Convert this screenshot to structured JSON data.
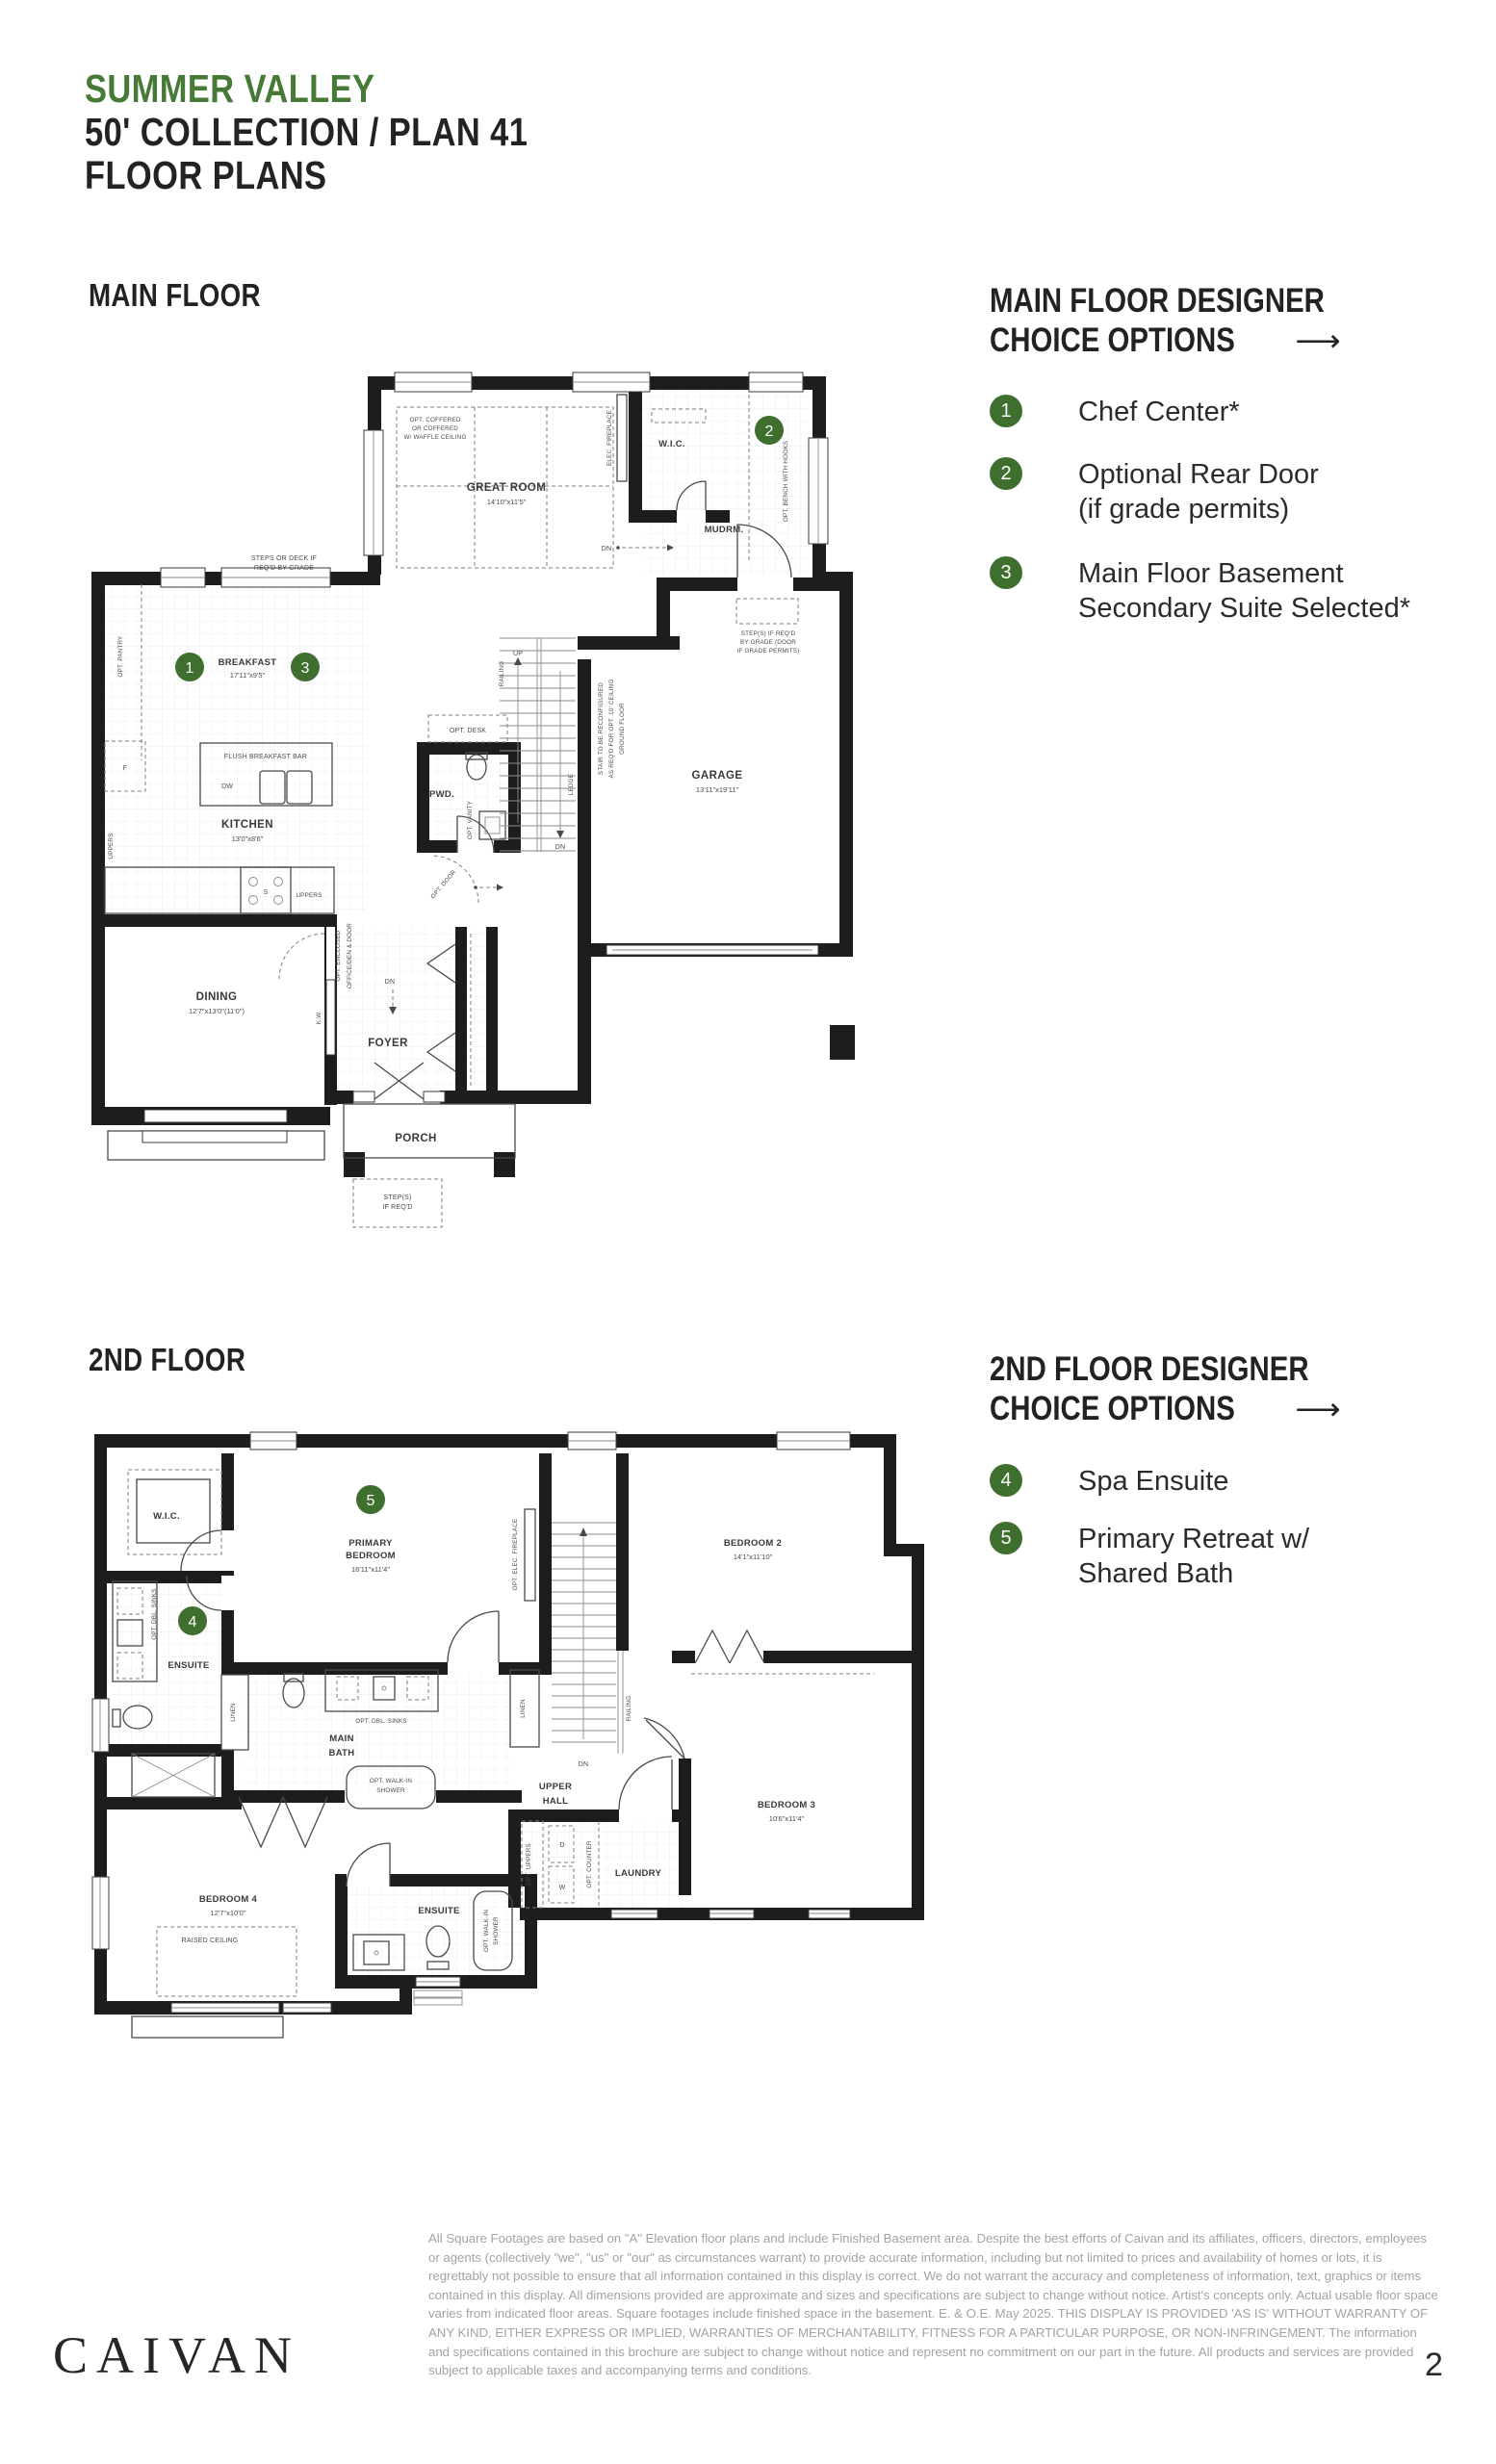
{
  "theme": {
    "green": "#3E6F2E",
    "ink": "#1d1d1d"
  },
  "header": {
    "community": "SUMMER VALLEY",
    "collection": "50' COLLECTION / PLAN 41",
    "title": "FLOOR PLANS"
  },
  "main_section": {
    "label": "MAIN FLOOR"
  },
  "second_section": {
    "label": "2ND FLOOR"
  },
  "main_options": {
    "heading1": "MAIN FLOOR DESIGNER",
    "heading2": "CHOICE OPTIONS",
    "arrow": "⟶",
    "items": [
      {
        "num": "1",
        "line1": "Chef Center*",
        "line2": ""
      },
      {
        "num": "2",
        "line1": "Optional Rear Door",
        "line2": "(if grade permits)"
      },
      {
        "num": "3",
        "line1": "Main Floor Basement",
        "line2": "Secondary Suite Selected*"
      }
    ]
  },
  "second_options": {
    "heading1": "2ND FLOOR DESIGNER",
    "heading2": "CHOICE OPTIONS",
    "arrow": "⟶",
    "items": [
      {
        "num": "4",
        "line1": "Spa Ensuite",
        "line2": ""
      },
      {
        "num": "5",
        "line1": "Primary Retreat w/",
        "line2": "Shared Bath"
      }
    ]
  },
  "main_plan": {
    "steps_deck1": "STEPS OR DECK IF",
    "steps_deck2": "REQ'D BY GRADE",
    "coffered1": "OPT. COFFERED",
    "coffered2": "OR COFFERED",
    "coffered3": "W/ WAFFLE CEILING",
    "great_room": "GREAT ROOM",
    "great_room_dims": "14'10\"x11'5\"",
    "elec_fireplace": "ELEC. FIREPLACE",
    "wic": "W.I.C.",
    "badge1": "1",
    "badge2": "2",
    "badge3": "3",
    "mudrm": "MUDRM.",
    "bench": "OPT. BENCH WITH HOOKS",
    "dn": "DN",
    "up": "UP",
    "breakfast": "BREAKFAST",
    "breakfast_dims": "17'11\"x9'5\"",
    "opt_pantry": "OPT. PANTRY",
    "flush_bar": "FLUSH BREAKFAST BAR",
    "dw": "DW",
    "fridge": "F",
    "sink": "S",
    "uppers": "UPPERS",
    "kitchen": "KITCHEN",
    "kitchen_dims": "13'0\"x8'6\"",
    "opt_desk": "OPT. DESK",
    "pwd": "PWD.",
    "opt_vanity": "OPT. VANITY",
    "railing": "RAILING",
    "ledge": "LEDGE",
    "stair_note1": "STAIR TO BE RECONFIGURED",
    "stair_note2": "AS REQ'D FOR OPT. 10' CEILING",
    "stair_note3": "GROUND FLOOR",
    "garage": "GARAGE",
    "garage_dims": "13'11\"x19'11\"",
    "gstep1": "STEP(S) IF REQ'D",
    "gstep2": "BY GRADE (DOOR",
    "gstep3": "IF GRADE PERMITS)",
    "dining": "DINING",
    "dining_dims": "12'7\"x13'0\"(11'0\")",
    "office1": "OPT. ENCLOSED",
    "office2": "OFFICE/DEN & DOOR",
    "kw": "K.W.",
    "opt_door": "OPT. DOOR",
    "foyer": "FOYER",
    "porch": "PORCH",
    "pstep1": "STEP(S)",
    "pstep2": "IF REQ'D"
  },
  "second_plan": {
    "wic": "W.I.C.",
    "badge4": "4",
    "badge5": "5",
    "primary1": "PRIMARY",
    "primary2": "BEDROOM",
    "primary_dims": "16'11\"x11'4\"",
    "fireplace": "OPT. ELEC. FIREPLACE",
    "bedroom2": "BEDROOM 2",
    "bedroom2_dims": "14'1\"x11'10\"",
    "dbl_sinks": "OPT. DBL. SINKS",
    "ensuite": "ENSUITE",
    "linen": "LINEN",
    "main1": "MAIN",
    "main2": "BATH",
    "walkin1": "OPT. WALK-IN",
    "walkin2": "SHOWER",
    "upper1": "UPPER",
    "upper2": "HALL",
    "railing": "RAILING",
    "dn": "DN",
    "laundry": "LAUNDRY",
    "opt_uppers": "OPT. UPPERS",
    "opt_counter": "OPT. COUNTER",
    "washer": "W",
    "dryer": "D",
    "bedroom3": "BEDROOM 3",
    "bedroom3_dims": "10'6\"x11'4\"",
    "bedroom4": "BEDROOM 4",
    "bedroom4_dims": "12'7\"x10'0\"",
    "raised": "RAISED CEILING"
  },
  "footer": {
    "disclaimer": "All Square Footages are based on \"A\" Elevation floor plans and include Finished Basement area. Despite the best efforts of Caivan and its affiliates, officers, directors, employees or agents (collectively \"we\", \"us\" or \"our\" as circumstances warrant) to provide accurate information, including but not limited to prices and availability of homes or lots, it is regrettably not possible to ensure that all information contained in this display is correct. We do not warrant the accuracy and completeness of information, text, graphics or items contained in this display. All dimensions provided are approximate and sizes and specifications are subject to change without notice. Artist's concepts only. Actual usable floor space varies from indicated floor areas. Square footages include finished space in the basement. E. & O.E. May 2025. THIS DISPLAY IS PROVIDED 'AS IS' WITHOUT WARRANTY OF ANY KIND, EITHER EXPRESS OR IMPLIED, WARRANTIES OF MERCHANTABILITY, FITNESS FOR A PARTICULAR PURPOSE, OR NON-INFRINGEMENT. The information and specifications contained in this brochure are subject to change without notice and represent no commitment on our part in the future. All products and services are provided subject to applicable taxes and accompanying terms and conditions.",
    "logo": "CAIVAN",
    "page": "2"
  }
}
